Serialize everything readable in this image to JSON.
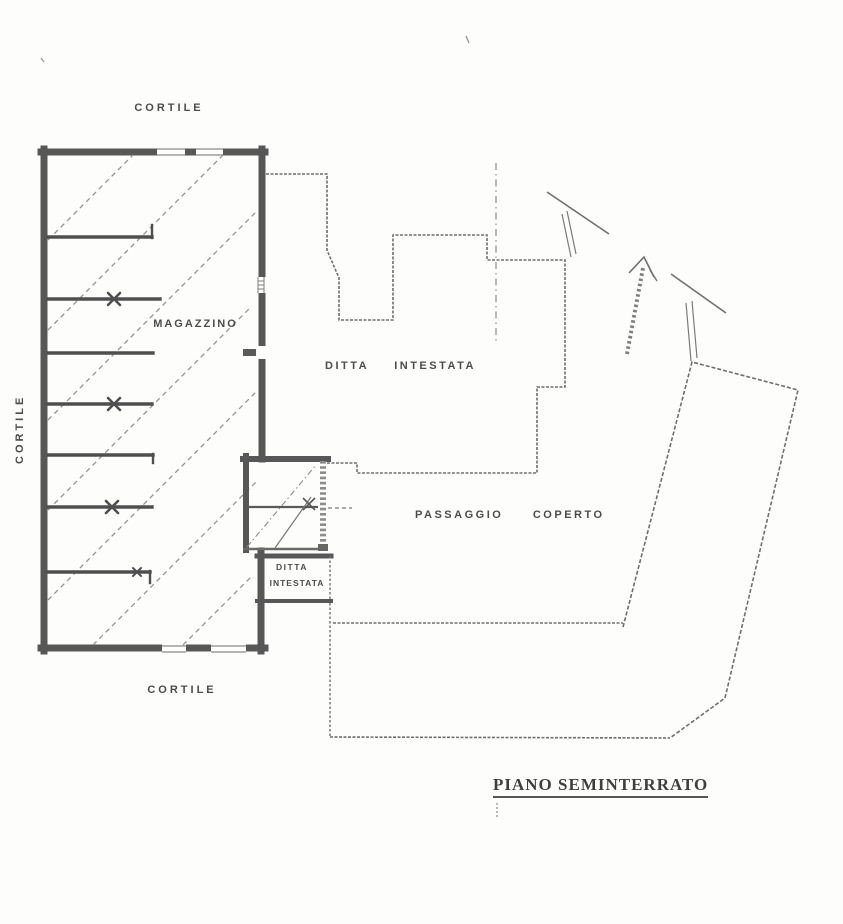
{
  "plan": {
    "labels": {
      "cortile_top": "CORTILE",
      "cortile_left": "CORTILE",
      "cortile_bottom": "CORTILE",
      "magazzino": "MAGAZZINO",
      "ditta_intestata_main": "DITTA INTESTATA",
      "passaggio_coperto": "PASSAGGIO COPERTO",
      "small_room_line1": "DITTA",
      "small_room_line2": "INTESTATA",
      "floor_title": "PIANO SEMINTERRATO"
    },
    "colors": {
      "paper": "#fdfdfc",
      "thick_wall": "#575757",
      "thin_line": "#6f6f6f",
      "hatch_line": "#949494",
      "label_text": "#4c4c4c"
    }
  }
}
